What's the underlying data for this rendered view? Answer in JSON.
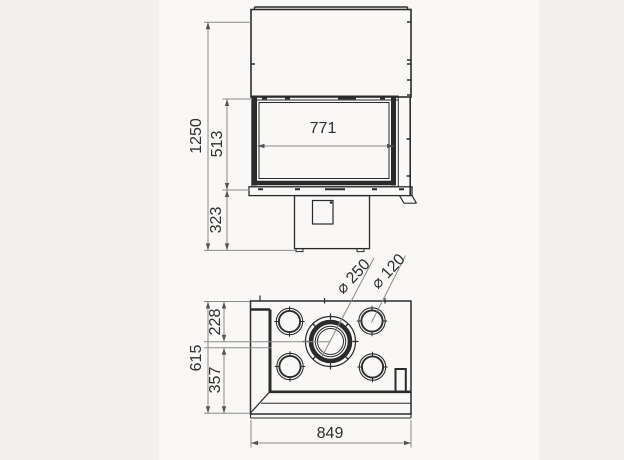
{
  "drawing": {
    "kind": "fireplace-insert technical drawing, front elevation and plan view",
    "front_view": {
      "overall_height": "1250",
      "glass_height": "513",
      "plinth_height": "323",
      "glass_width": "771"
    },
    "top_view": {
      "overall_depth": "615",
      "flue_center_from_back": "228",
      "flue_center_to_front": "357",
      "overall_width": "849",
      "flue_diameter": "⌀ 250",
      "air_vent_diameter": "⌀ 120"
    },
    "colors": {
      "page_background": "#f1f0ed",
      "panel_background": "#f9f8f6",
      "object_line": "#2b2b2b",
      "dimension_line": "#8a8a8a",
      "text": "#2e2e2e"
    }
  }
}
